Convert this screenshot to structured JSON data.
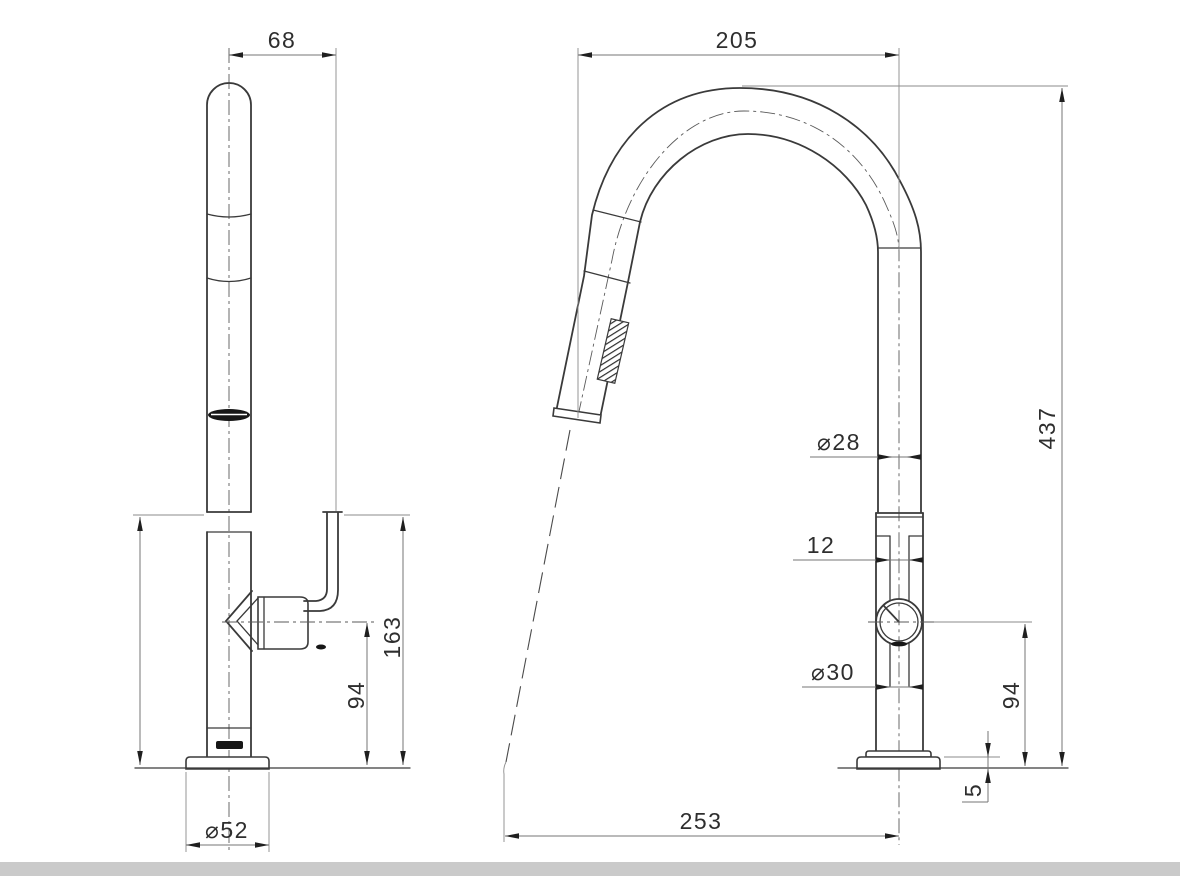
{
  "page": {
    "background": "#ffffff",
    "bottom_bar_color": "#cacaca",
    "bottom_bar_style": "background:#cacaca;"
  },
  "drawing": {
    "kind": "technical-dimension-drawing",
    "subject": "pull-out gooseneck sink mixer tap, two orthographic views",
    "unit_note": "mm",
    "line_color": "#3a3a3a",
    "dim_color": "#767676",
    "front_view": {
      "dims": {
        "spout_to_lever_offset": "68",
        "lever_top_height": "163",
        "handle_centre_height": "94",
        "base_diameter": "⌀52"
      }
    },
    "side_view": {
      "dims": {
        "spout_reach": "205",
        "overall_height": "437",
        "spout_tube_diameter": "⌀28",
        "cartridge_width": "12",
        "body_diameter": "⌀30",
        "handle_centre_height": "94",
        "base_plate_thickness": "5",
        "outlet_projection": "253"
      }
    }
  }
}
